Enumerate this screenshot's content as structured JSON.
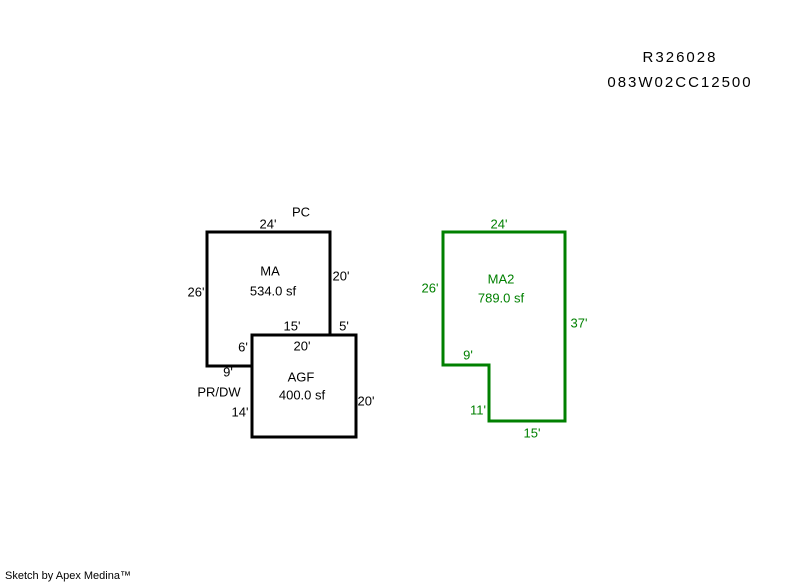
{
  "header": {
    "line1": "R326028",
    "line2": "083W02CC12500"
  },
  "buildings": {
    "ma": {
      "name": "MA",
      "area": "534.0 sf",
      "attached_label": "PC",
      "dims": {
        "top": "24'",
        "left": "26'",
        "right": "20'",
        "bottom_shared": "15'",
        "notch": "6'",
        "bottom": "9'"
      }
    },
    "agf": {
      "name": "AGF",
      "area": "400.0 sf",
      "attached_label": "PR/DW",
      "dims": {
        "top": "20'",
        "top_right": "5'",
        "right": "20'",
        "left": "14'"
      }
    },
    "ma2": {
      "name": "MA2",
      "area": "789.0 sf",
      "dims": {
        "top": "24'",
        "left": "26'",
        "right": "37'",
        "notch_bottom": "9'",
        "notch_side": "11'",
        "bottom": "15'"
      }
    }
  },
  "colors": {
    "default_outline": "#000000",
    "ma2_outline": "#008000"
  },
  "footer": {
    "credit": "Sketch by Apex Medina™"
  }
}
